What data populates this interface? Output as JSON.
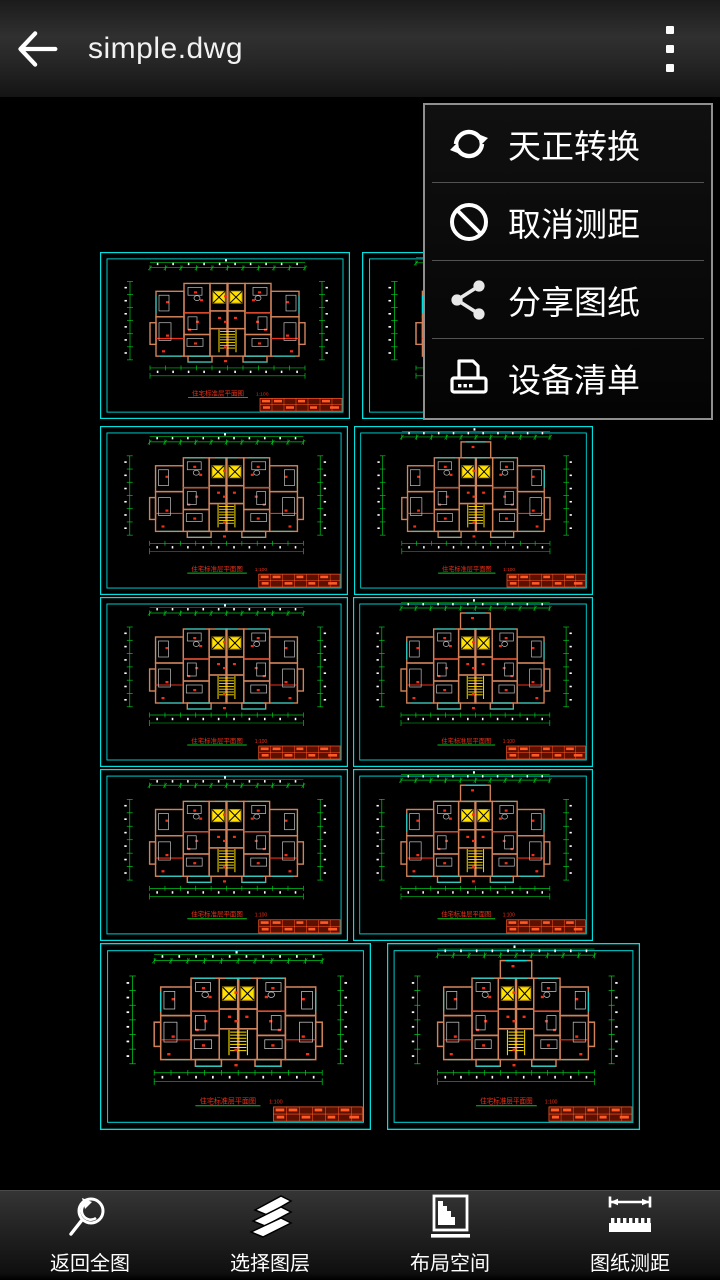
{
  "app": {
    "title": "simple.dwg"
  },
  "menu": {
    "items": [
      {
        "label": "天正转换",
        "icon": "sync-icon"
      },
      {
        "label": "取消测距",
        "icon": "cancel-icon"
      },
      {
        "label": "分享图纸",
        "icon": "share-icon"
      },
      {
        "label": "设备清单",
        "icon": "printer-icon"
      }
    ]
  },
  "toolbar": {
    "items": [
      {
        "label": "返回全图",
        "icon": "zoom-extents-icon"
      },
      {
        "label": "选择图层",
        "icon": "layers-icon"
      },
      {
        "label": "布局空间",
        "icon": "layout-icon"
      },
      {
        "label": "图纸测距",
        "icon": "measure-icon"
      }
    ]
  },
  "canvas": {
    "background": "#000000",
    "plan_title": "住宅标准层平面图",
    "plan_scale": "1:100",
    "colors": {
      "cyan": "#00dede",
      "green": "#00c81e",
      "wall": "#d0835a",
      "red": "#f03018",
      "yellow": "#ffe100",
      "furniture": "#c4c4c4",
      "block_bg": "#5c1000",
      "block_line": "#ff5a26",
      "white": "#ffffff"
    },
    "tiles": [
      {
        "x": 100,
        "y": 252,
        "w": 250,
        "h": 167,
        "bump": false
      },
      {
        "x": 362,
        "y": 252,
        "w": 270,
        "h": 167,
        "bump": true
      },
      {
        "x": 100,
        "y": 426,
        "w": 248,
        "h": 169,
        "bump": false
      },
      {
        "x": 354,
        "y": 426,
        "w": 239,
        "h": 169,
        "bump": true
      },
      {
        "x": 100,
        "y": 597,
        "w": 248,
        "h": 170,
        "bump": false
      },
      {
        "x": 353,
        "y": 597,
        "w": 240,
        "h": 170,
        "bump": true
      },
      {
        "x": 100,
        "y": 769,
        "w": 248,
        "h": 172,
        "bump": false
      },
      {
        "x": 353,
        "y": 769,
        "w": 240,
        "h": 172,
        "bump": true
      },
      {
        "x": 100,
        "y": 943,
        "w": 271,
        "h": 187,
        "bump": false
      },
      {
        "x": 387,
        "y": 943,
        "w": 253,
        "h": 187,
        "bump": true
      }
    ]
  }
}
